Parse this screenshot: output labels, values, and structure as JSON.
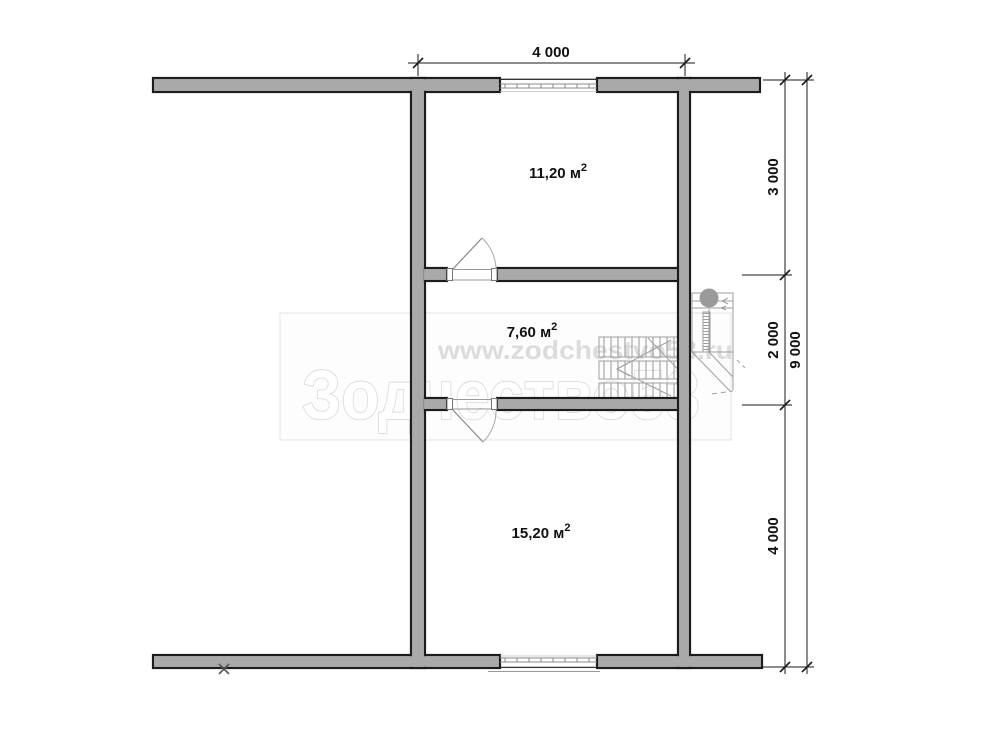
{
  "plan": {
    "type": "floor-plan",
    "rooms": [
      {
        "name": "room-upper",
        "area": "11,20 м",
        "sup": "2"
      },
      {
        "name": "room-middle",
        "area": "7,60 м",
        "sup": "2"
      },
      {
        "name": "room-lower",
        "area": "15,20 м",
        "sup": "2"
      }
    ],
    "dimensions": {
      "top_width": "4 000",
      "right_segments": [
        "3 000",
        "2 000",
        "4 000"
      ],
      "right_total": "9 000"
    }
  },
  "watermark": {
    "url": "www.zodchestvo53.ru",
    "brand": "Зодчество53"
  },
  "colors": {
    "wall_fill": "#a9a9a9",
    "wall_outline": "#1c1c1c",
    "dim_color": "#1a1a1a",
    "light_detail": "#9e9e9e",
    "watermark_url": "#dcdcdc",
    "watermark_stroke": "#d6d6d6",
    "watermark_border": "#e3e3e3"
  }
}
